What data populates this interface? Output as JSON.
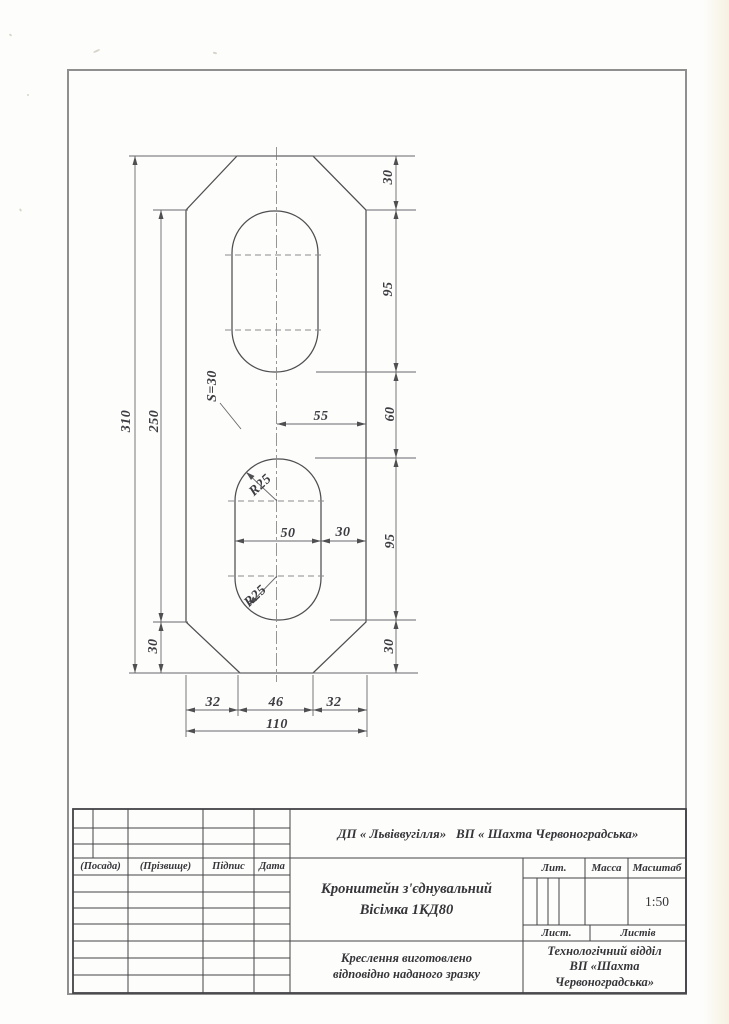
{
  "drawing": {
    "dim_310": "310",
    "dim_250": "250",
    "dim_30_left_bottom": "30",
    "dim_30_top_right": "30",
    "dim_95_top": "95",
    "dim_60": "60",
    "dim_95_bottom": "95",
    "dim_30_bottom_right": "30",
    "dim_55": "55",
    "dim_50": "50",
    "dim_30_mid": "30",
    "dim_32_left": "32",
    "dim_46": "46",
    "dim_32_right": "32",
    "dim_110": "110",
    "radius_upper": "R25",
    "radius_lower": "R25",
    "thickness": "S=30"
  },
  "title_block": {
    "org": "ДП « Львіввугілля»   ВП « Шахта Червоноградська»",
    "col_posada": "(Посада)",
    "col_prizvyshche": "(Прізвище)",
    "col_pidpys": "Підпис",
    "col_data": "Дата",
    "title_line1": "Кронштейн з'єднувальний",
    "title_line2": "Вісімка 1КД80",
    "lit": "Лит.",
    "massa": "Масса",
    "masshtab": "Масштаб",
    "scale": "1:50",
    "list": "Лист.",
    "listiv": "Листів",
    "note_line1": "Креслення виготовлено",
    "note_line2": "відповідно наданого зразку",
    "dept_line1": "Технологічний відділ",
    "dept_line2": "ВП «Шахта",
    "dept_line3": "Червоноградська»"
  },
  "colors": {
    "outline": "#4f4f52",
    "dimline": "#68686c",
    "frame": "#8f8f90",
    "table": "#434347"
  }
}
